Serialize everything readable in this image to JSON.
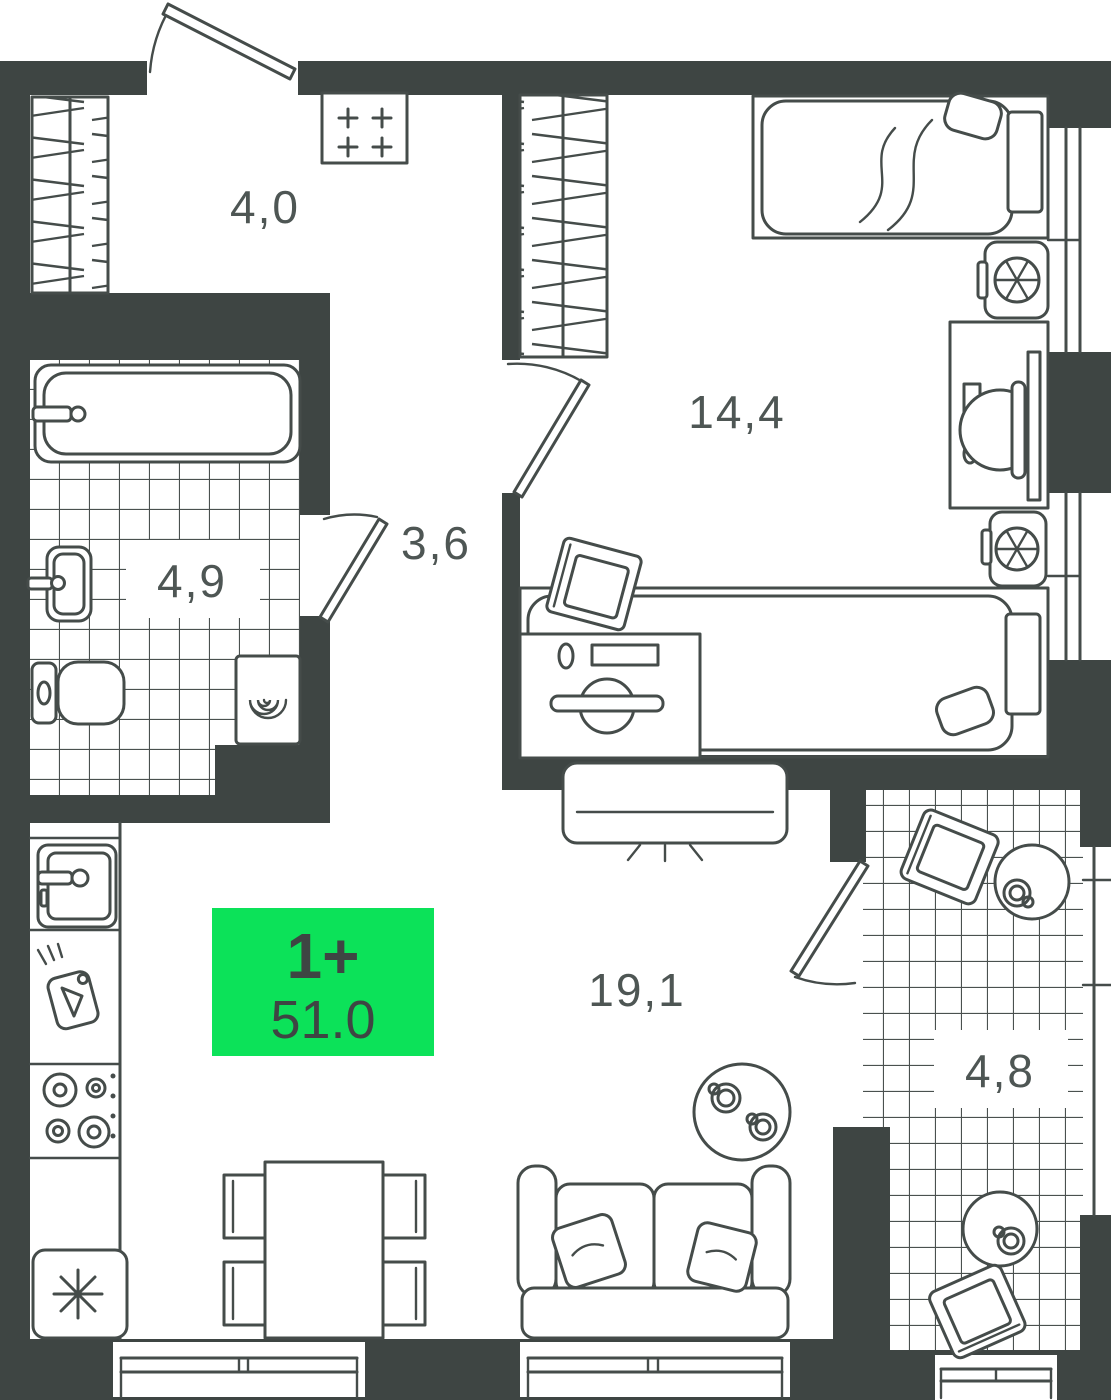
{
  "plan": {
    "kind": "apartment-floor-plan",
    "badge": {
      "type_label": "1+",
      "area_value": "51.0",
      "bg_color": "#0ce259",
      "text_color": "#3e4543"
    },
    "rooms": [
      {
        "id": "hallway",
        "area_label": "4,0"
      },
      {
        "id": "bathroom",
        "area_label": "4,9"
      },
      {
        "id": "corridor",
        "area_label": "3,6"
      },
      {
        "id": "bedroom",
        "area_label": "14,4"
      },
      {
        "id": "kitchen-living-room",
        "area_label": "19,1"
      },
      {
        "id": "balcony",
        "area_label": "4,8"
      }
    ],
    "colors": {
      "walls": "#3e4543",
      "furniture_lines": "#454c4a",
      "background": "#ffffff",
      "room_labels": "#4e5654"
    }
  }
}
